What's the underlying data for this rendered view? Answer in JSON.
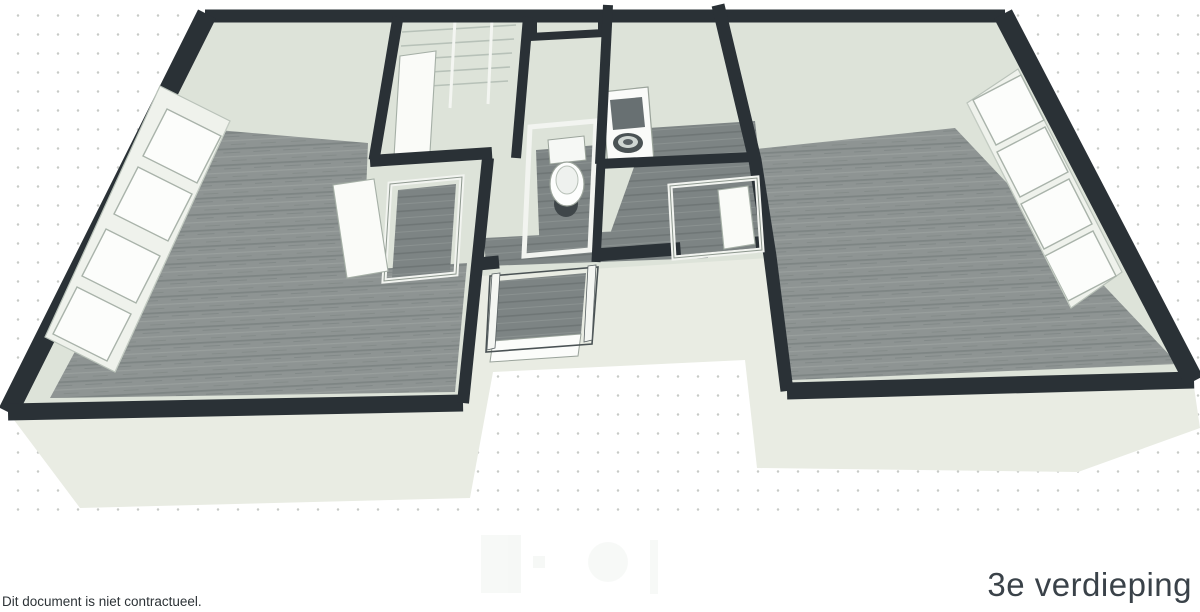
{
  "page": {
    "title": "3e verdieping",
    "disclaimer": "Dit document is niet contractueel."
  },
  "colors": {
    "background": "#ffffff",
    "dot_grid": "#c7cac6",
    "wall_dark": "#2a3136",
    "wall_face": "#dde3d9",
    "skirt": "#e9ece3",
    "floor_wood": "#8e9493",
    "floor_hall": "#7d8484",
    "floor_dark": "#757c7c",
    "window_white": "#fcfdfb",
    "text": "#3a4249"
  },
  "floorplan": {
    "view": "3D floor plan, third storey",
    "fixtures": [
      "toilet",
      "washbasin",
      "closet-shelves",
      "entrance-door",
      "interior-door",
      "windows"
    ]
  }
}
